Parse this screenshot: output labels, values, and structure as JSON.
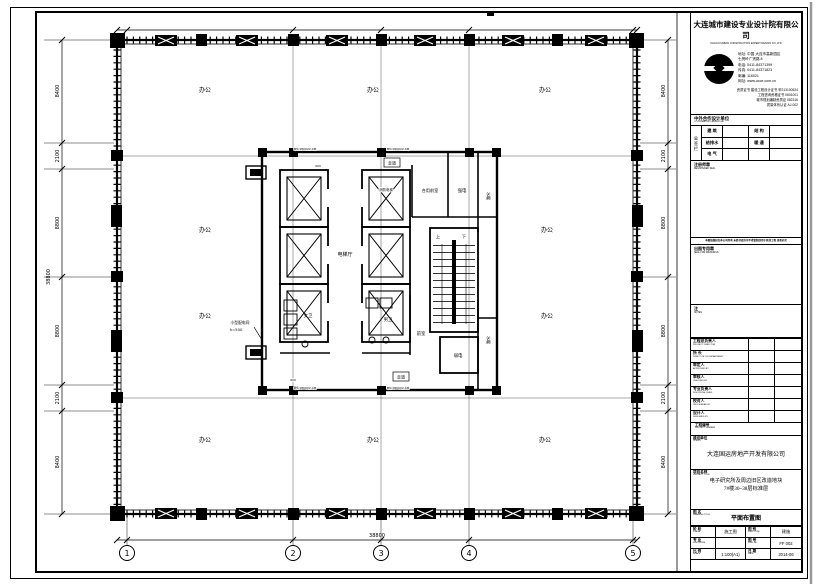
{
  "title_block": {
    "company_cn": "大连城市建设专业设计院有限公司",
    "company_en": "DALIAN URBAN CONSTRUCTION EXPERT DESIGN CO.,LTD",
    "contact_lines": [
      "地址: 中国 大连市高新园区",
      "七贤岭广贤路 8",
      "电话: 0411-84371399",
      "传真: 0411-84371823",
      "邮编: 116021",
      "网址: www.ucce.com.cn"
    ],
    "cert_lines": [
      "资质证书  建设工程设计证书 甲213100524",
      "工程咨询资格证书 0601001",
      "城市规划编制资质证 082316",
      "质量体系认证 AJ-002"
    ],
    "coop_header_cn": "中外合作设计单位",
    "coop_header_en": "COOPERATIVE DESIGN UNIT",
    "sign_col_label": "会签栏",
    "sign_rows": [
      {
        "l": "建 筑",
        "r": "结 构"
      },
      {
        "l": "给排水",
        "r": "暖 通"
      },
      {
        "l": "电 气",
        "r": ""
      }
    ],
    "seal1_cn": "注册师章",
    "seal1_en": "REGISTERED SEAL",
    "disclaimer": "本图纸版权归本公司所有 未经书面许可不得复制或用于其他工程 违者必究",
    "seal2_cn": "出图专用章",
    "seal2_en": "SEAL FOR DRAWINGS",
    "notes_cn": "注",
    "notes_en": "NOTES",
    "personnel": [
      {
        "cn": "工程总负责人",
        "en": "PROJECT DIRECTOR"
      },
      {
        "cn": "所  长",
        "en": "DIRECTOR OF DEPARTMENT"
      },
      {
        "cn": "审定人",
        "en": "APPROVED BY"
      },
      {
        "cn": "审核人",
        "en": "CHECKED BY"
      },
      {
        "cn": "专业负责人",
        "en": "DISCIPLINE CHIEF"
      },
      {
        "cn": "校对人",
        "en": "PROOFREAD BY"
      },
      {
        "cn": "设计人",
        "en": "DESIGNED BY"
      }
    ],
    "project_no_cn": "工程编号",
    "project_no_en": "PROJECT NUMBER",
    "client_cn": "建设单位",
    "client_en": "CLIENT",
    "client_value": "大连国运房地产开发有限公司",
    "project_cn": "项目名称",
    "project_en": "PROJECT TITLE",
    "project_line1": "电子研究所及周边旧区改造地块",
    "project_line2": "7#楼30~38层标准层",
    "drawing_cn": "图 名",
    "drawing_en": "DRAWING TITLE",
    "drawing_value": "平面布置图",
    "bottom_left": [
      {
        "cn": "阶 段",
        "en": "STAGE",
        "value": "施工图"
      },
      {
        "cn": "专 业",
        "en": "DISCIPLINE",
        "value": ""
      },
      {
        "cn": "比 例",
        "en": "SCALE",
        "value": "1:100(A1)"
      }
    ],
    "bottom_right": [
      {
        "cn": "图 别",
        "en": "DWG TYPE",
        "value": "建施"
      },
      {
        "cn": "图 号",
        "en": "DWG No.",
        "value": "FF 002"
      },
      {
        "cn": "日 期",
        "en": "DATE",
        "value": "2014-06"
      }
    ]
  },
  "plan": {
    "office_label": "办公",
    "rooms": {
      "elevator_hall": "电梯厅",
      "fire_elevator": "消防电梯",
      "shared_lobby": "合用前室",
      "strong_electric": "强电",
      "water_top": "水暖",
      "water_bottom": "水暖",
      "weak_electric": "弱电",
      "mens_wc": "男卫",
      "womens_wc": "女卫",
      "lobby": "前室",
      "corridor_top": "走道",
      "corridor_bottom": "走道",
      "stair_up": "上",
      "stair_down": "下"
    },
    "weak_electric_color": "#2233bb",
    "annotation_line1": "小型配电间",
    "annotation_line2": "h=500",
    "wall_tag": "M5/1800X2.4M",
    "small_dim": "900",
    "dims_left": [
      "8400",
      "2100",
      "8800",
      "8800",
      "2100",
      "8400"
    ],
    "dims_right": [
      "8400",
      "2100",
      "8800",
      "8800",
      "2100",
      "8400"
    ],
    "total_left": "38800",
    "total_bottom": "38800",
    "grid_bubbles": [
      "1",
      "2",
      "3",
      "4",
      "5"
    ]
  }
}
